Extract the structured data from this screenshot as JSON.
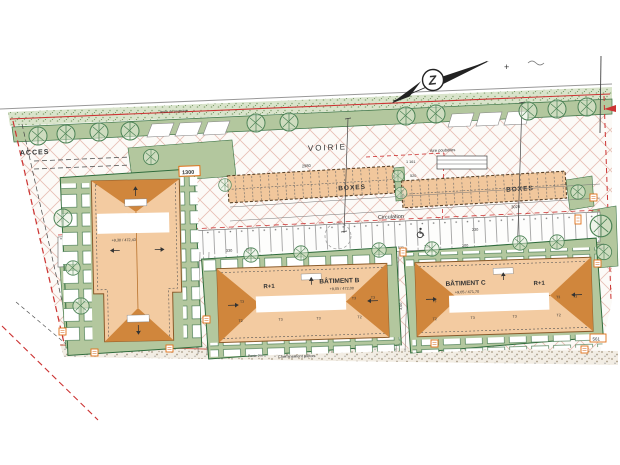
{
  "labels": {
    "acces": "ACCES",
    "voirie": "VOIRIE",
    "circulation": "Circulation",
    "boxes_left": "BOXES",
    "boxes_right": "BOXES",
    "aire_poubelles": "Aire poubelles",
    "limite_propriete": "limite de propriété",
    "cheminement_b": "Cheminement piéton",
    "cheminement_c": "Cheminement piéton",
    "pente_b": "Pente 2%",
    "pente_c": "Pente 2%",
    "north_letter": "Z",
    "plus_mark": "+"
  },
  "buildings": {
    "a": {
      "levels": "+9,30 / 472,43"
    },
    "b": {
      "name": "BÂTIMENT B",
      "floors": "R+1",
      "levels": "+9,05 / 472,00",
      "units_top": [
        "T3",
        "T3",
        "T3"
      ],
      "units_bottom": [
        "T2",
        "T3",
        "T3",
        "T2"
      ]
    },
    "c": {
      "name": "BÂTIMENT C",
      "floors": "R+1",
      "levels": "+9,05 / 471,70",
      "units_top": [
        "T3",
        "T3",
        "T3"
      ],
      "units_bottom": [
        "T2",
        "T3",
        "T3",
        "T2"
      ]
    }
  },
  "dimensions": {
    "boxes_left_len": "2980",
    "boxes_right_len": "3020",
    "d1161": "1 161",
    "d520": "520",
    "d330": "330",
    "d250": "250",
    "d511": "511",
    "d704": "704",
    "d230": "230",
    "d200": "200",
    "d300": "3,00",
    "tag_1300": "1300",
    "tag_561": "561"
  },
  "colors": {
    "building_fill": "#f3cba1",
    "roof_fill": "#d0863c",
    "green_fill": "#b3c79e",
    "boundary_red": "#cc3333",
    "tag_orange": "#e07018"
  }
}
